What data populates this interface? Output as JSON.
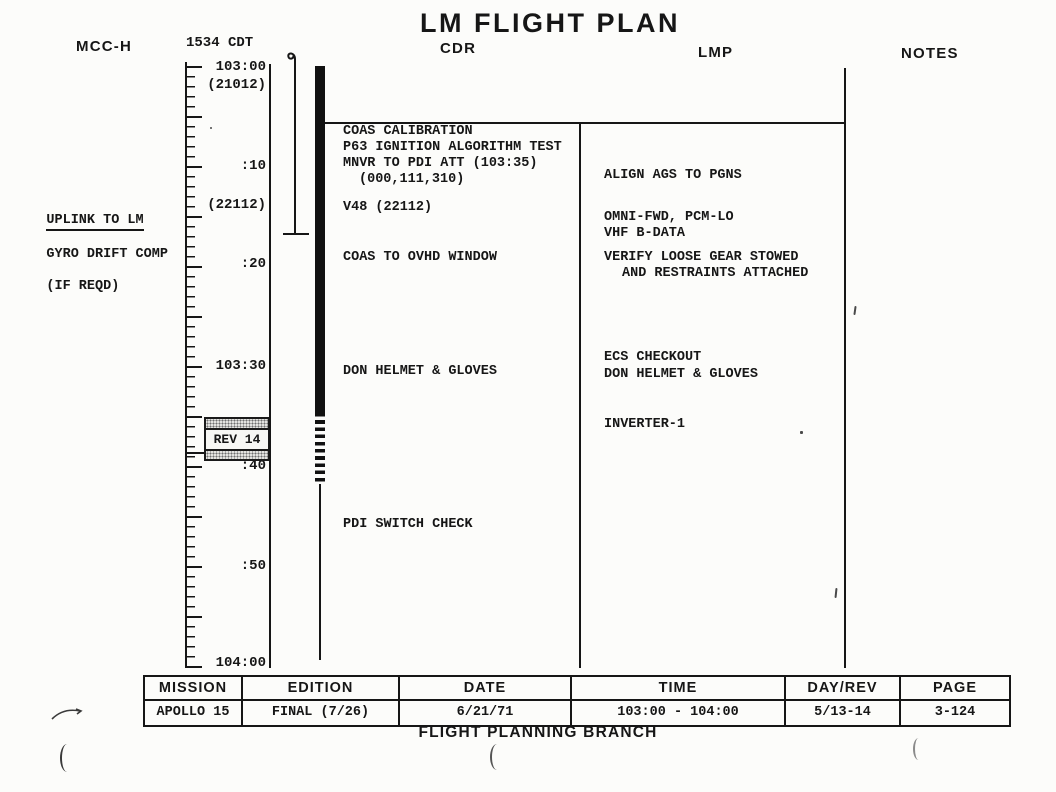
{
  "title": "LM FLIGHT PLAN",
  "header": {
    "mcc_label": "MCC-H",
    "clock": "1534 CDT",
    "cdr_label": "CDR",
    "lmp_label": "LMP",
    "notes_label": "NOTES"
  },
  "uplink_note": {
    "line1": "UPLINK TO LM",
    "line2": "GYRO DRIFT COMP",
    "line3": "(IF REQD)"
  },
  "timeline": {
    "labels": [
      "103:00",
      "(21012)",
      ":10",
      "(22112)",
      ":20",
      "103:30",
      ":40",
      ":50",
      "104:00"
    ],
    "rev_badge": "REV 14"
  },
  "columns": {
    "cdr": {
      "items": [
        "COAS CALIBRATION",
        "P63 IGNITION ALGORITHM TEST",
        "MNVR TO PDI ATT (103:35)",
        "(000,111,310)",
        "V48 (22112)",
        "COAS TO OVHD WINDOW",
        "DON HELMET & GLOVES",
        "PDI SWITCH CHECK"
      ]
    },
    "lmp": {
      "items": [
        "ALIGN AGS TO PGNS",
        "OMNI-FWD, PCM-LO",
        "VHF B-DATA",
        "VERIFY LOOSE GEAR STOWED",
        "AND RESTRAINTS ATTACHED",
        "ECS CHECKOUT",
        "DON HELMET & GLOVES",
        "INVERTER-1"
      ]
    }
  },
  "footer_table": {
    "headers": [
      "MISSION",
      "EDITION",
      "DATE",
      "TIME",
      "DAY/REV",
      "PAGE"
    ],
    "values": [
      "APOLLO 15",
      "FINAL (7/26)",
      "6/21/71",
      "103:00 - 104:00",
      "5/13-14",
      "3-124"
    ]
  },
  "footer": "FLIGHT PLANNING BRANCH",
  "ink_color": "#161616"
}
